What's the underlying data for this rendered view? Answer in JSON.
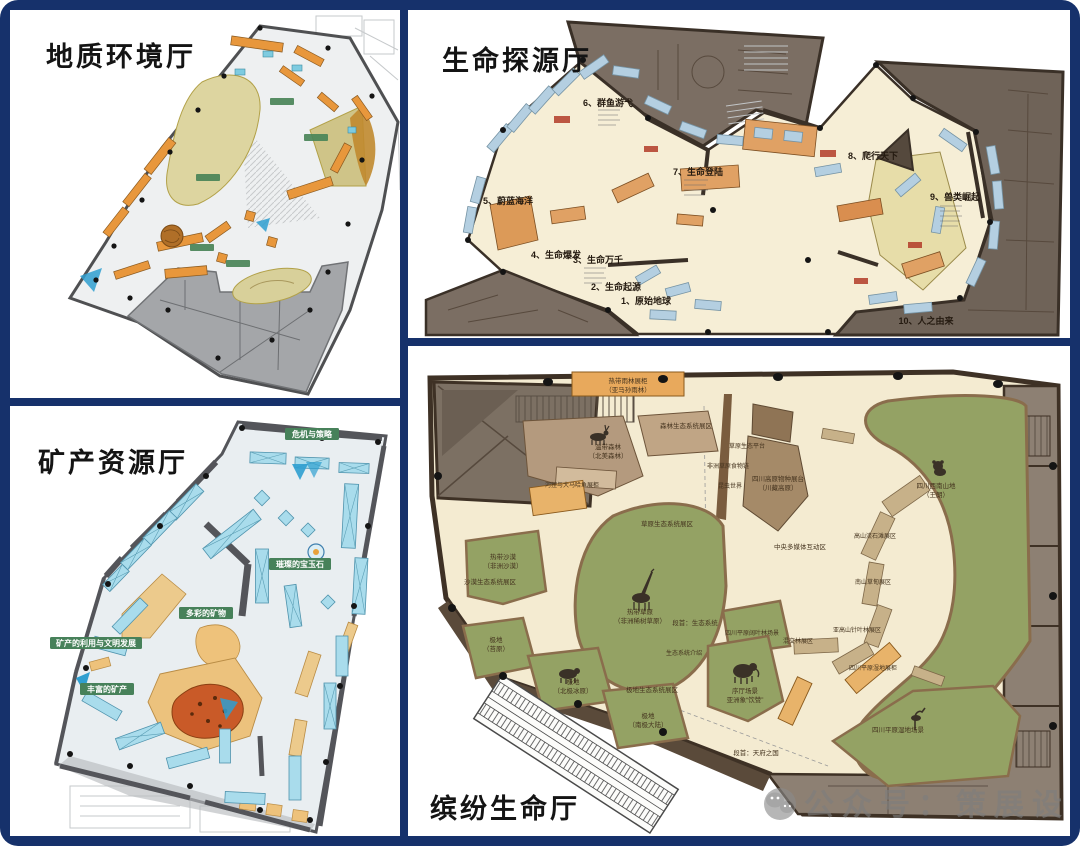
{
  "frame": {
    "background": "#ffffff",
    "border_color": "#16316b"
  },
  "colors": {
    "floor_cream": "#f3ead0",
    "floor_gray": "#e9eef1",
    "green_zone": "#94a264",
    "case_blue": "#b4cfe1",
    "case_cyan": "#a9dcec",
    "exhibit_orange": "#e2a164",
    "label_green": "#47815a",
    "wall_dark_brown": "#3e3125",
    "wing_brown": "#7b6e63"
  },
  "halls": {
    "geology": {
      "title": "地质环境厅"
    },
    "life_origin": {
      "title": "生命探源厅",
      "zones": {
        "z1": "1、原始地球",
        "z2": "2、生命起源",
        "z3": "3、生命万千",
        "z4": "4、生命爆发",
        "z5": "5、蔚蓝海洋",
        "z6": "6、群鱼游弋",
        "z7": "7、生命登陆",
        "z8": "8、爬行天下",
        "z9": "9、兽类崛起",
        "z10": "10、人之由来"
      }
    },
    "minerals": {
      "title": "矿产资源厅",
      "sections": {
        "crisis": "危机与策略",
        "gems": "璀璨的宝玉石",
        "colorful": "多彩的矿物",
        "usage": "矿产的利用与文明发展",
        "rich": "丰富的矿产"
      }
    },
    "colorful_life": {
      "title": "缤纷生命厅",
      "labels": {
        "rainforest_case_1": "热带雨林展柜",
        "rainforest_case_2": "（亚马孙雨林）",
        "temperate_forest_1": "温带森林",
        "temperate_forest_2": "（北美森林）",
        "forest_zone": "森林生态系统展区",
        "grass_platform": "草原生态平台",
        "africa_chain": "非洲草原食物链",
        "insect_world": "昆虫世界",
        "beaver_case": "河狸与大马哈鱼展柜",
        "grass_zone": "草原生态系统展区",
        "savanna_1": "热带草原",
        "savanna_2": "（非洲稀树草原）",
        "desert_1": "热带沙漠",
        "desert_2": "（非洲沙漠）",
        "desert_zone": "沙漠生态系统展区",
        "polar_tundra_1": "极地",
        "polar_tundra_2": "（苔原）",
        "polar_arctic_1": "极地",
        "polar_arctic_2": "（北极冰原）",
        "polar_antarctic_1": "极地",
        "polar_antarctic_2": "（南极大陆）",
        "polar_zone": "极地生态系统展区",
        "intro_eco": "段首：生态系统",
        "eco_intro": "生态系统介绍",
        "plateau_case_1": "四川高原物种展台",
        "plateau_case_2": "（川藏高原）",
        "southwest_1": "四川西南山地",
        "southwest_2": "（王朗）",
        "media_zone": "中央多媒体互动区",
        "scree_zone": "高山流石滩展区",
        "meadow_zone": "南山草甸展区",
        "subalpine_zone": "亚高山针叶林展区",
        "broadleaf_scene": "四川平原阔叶林场景",
        "mixed_zone": "混交林展区",
        "wetland_case": "四川平原湿地展柜",
        "lobby_scene_1": "序厅场景",
        "lobby_scene_2": "亚洲象“饮赞”",
        "wetland_scene": "四川平原湿地场景",
        "intro_tianfu": "段首：天府之国"
      }
    }
  },
  "watermark": {
    "text": "公众号：策展设计",
    "icon": "wechat-icon"
  }
}
